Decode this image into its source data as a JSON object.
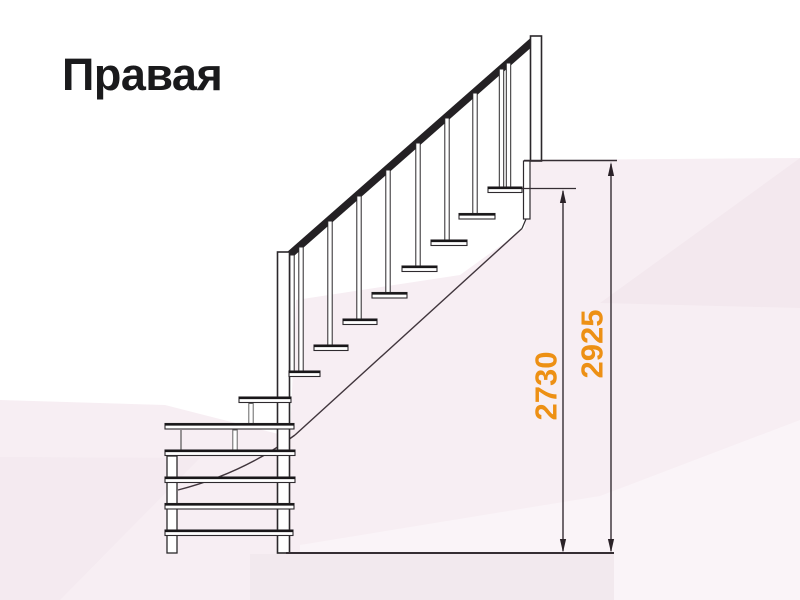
{
  "title": "Правая",
  "dimensions": {
    "tread_height": "2730",
    "floor_height": "2925"
  },
  "colors": {
    "dimension_accent": "#ED9014",
    "drawing_lines": "#2B282B",
    "title_text": "#1A1A1C",
    "background_tint": "#F7EEF3"
  }
}
